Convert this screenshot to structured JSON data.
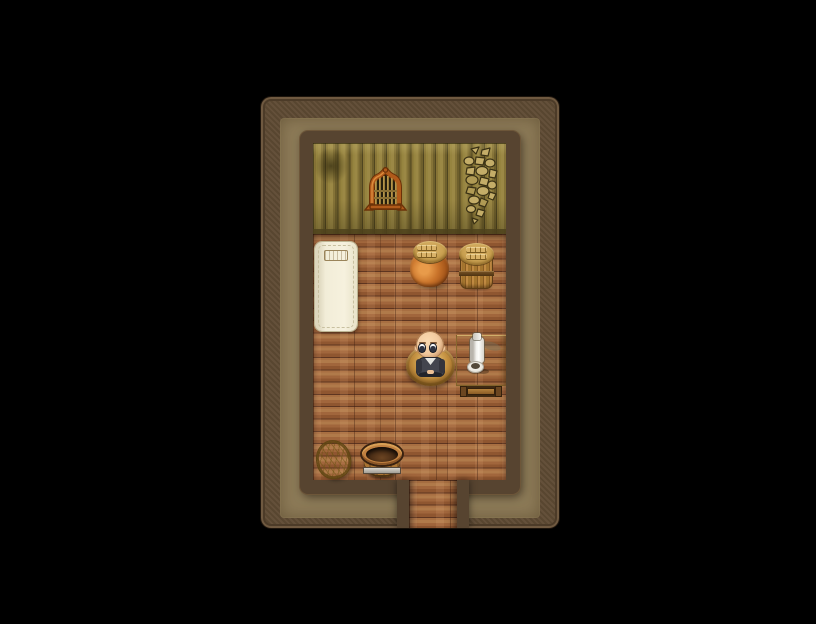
{
  "scene": {
    "description": "Top-down RPG room interior in a framed diorama on a black screen",
    "tile_size_px": 48,
    "room": {
      "floor_cols": 4,
      "floor_rows": 5,
      "wall_rows": 2,
      "door_tile_col": 3
    }
  },
  "objects": {
    "bed": {
      "label": "white futon bed with tan pillow"
    },
    "pot": {
      "label": "clay pot with woven lid"
    },
    "barrel": {
      "label": "wooden barrel with woven lid"
    },
    "window": {
      "label": "arched barred window"
    },
    "crack": {
      "label": "cracked plaster on wall"
    },
    "stain": {
      "label": "dark stain on wall planks"
    },
    "mat": {
      "label": "round woven mat"
    },
    "character": {
      "label": "bald villager seated on mat",
      "pose": "seated",
      "facing": "viewer",
      "hair": "bald",
      "outfit": "dark vest with white collar"
    },
    "table": {
      "label": "wooden table against right wall"
    },
    "bottle": {
      "label": "white bottle on table"
    },
    "bowl": {
      "label": "white bowl on table"
    },
    "basket": {
      "label": "golden woven basket"
    },
    "tub": {
      "label": "empty wooden tub with metal band"
    },
    "door": {
      "label": "doorway exit at bottom of room"
    },
    "floor": {
      "label": "wooden plank floor"
    },
    "wall": {
      "label": "olive wooden plank wall"
    }
  },
  "palette": {
    "background": "#000000",
    "frame_wood": "#5e4a33",
    "walkway_tan": "#8d7b58",
    "wall_border": "#574430",
    "wall_olive": "#8d7a3e",
    "floor_wood": "#9c6238",
    "floor_gap": "#5e3520",
    "bed_linen": "#f2edd8",
    "pillow_tan": "#d9c28c",
    "pot_clay": "#c9732a",
    "lid_weave": "#c9a050",
    "barrel_wood": "#a5762f",
    "window_frame": "#b05a1a",
    "crack_stone": "#c4ad68",
    "mat_weave": "#c08c3c",
    "skin": "#f0c79c",
    "vest": "#43454e",
    "table_wood": "#c9a055",
    "porcelain": "#f6f6f2",
    "basket_gold": "#d4b13c",
    "tub_wood": "#aa7433",
    "metal_band": "#c6c2ba"
  }
}
